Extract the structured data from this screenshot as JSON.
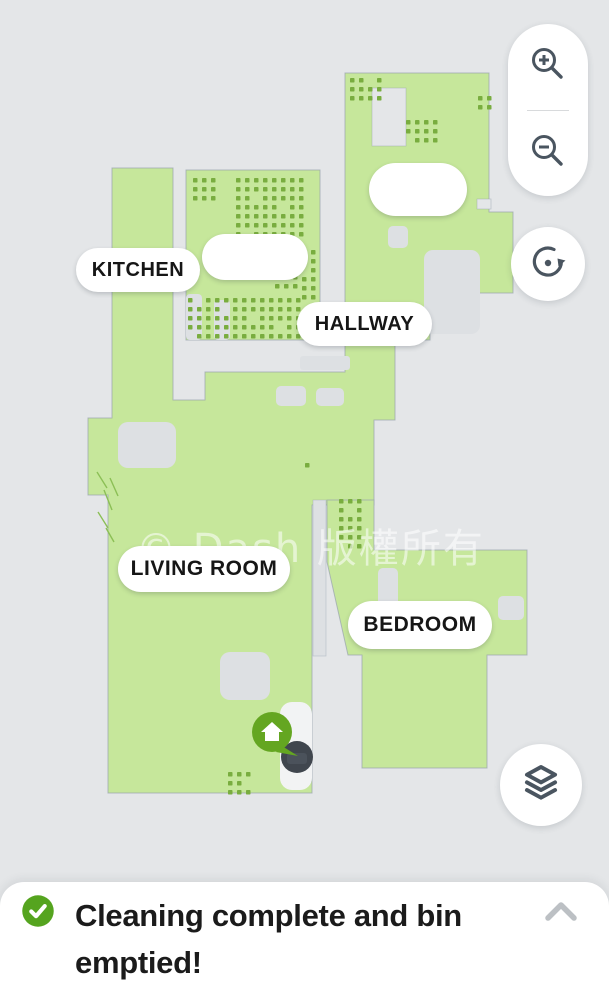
{
  "colors": {
    "background": "#e4e6e8",
    "map_green": "#c6e79b",
    "carpet_dot": "#79ad3f",
    "map_outline": "#97a3ad",
    "obstacle": "#dde0e3",
    "icon": "#4a5560",
    "robot": "#40464e",
    "dock_green": "#64a621",
    "check_green": "#55a41f"
  },
  "map": {
    "rooms": [
      {
        "id": "kitchen",
        "label": "KITCHEN"
      },
      {
        "id": "hallway",
        "label": "HALLWAY"
      },
      {
        "id": "living-room",
        "label": "LIVING ROOM"
      },
      {
        "id": "bedroom",
        "label": "BEDROOM"
      },
      {
        "id": "unnamed-top-room",
        "label": ""
      },
      {
        "id": "unnamed-kitchen-room",
        "label": ""
      }
    ],
    "markers": [
      {
        "id": "dock",
        "icon": "home-icon"
      },
      {
        "id": "robot",
        "icon": "robot-vacuum"
      }
    ],
    "watermark": "© Dash 版權所有"
  },
  "controls": {
    "zoom_in": {
      "icon": "zoom-in-icon"
    },
    "zoom_out": {
      "icon": "zoom-out-icon"
    },
    "rotate": {
      "icon": "rotate-map-icon"
    },
    "layers": {
      "icon": "map-layers-icon"
    }
  },
  "status": {
    "message": "Cleaning complete and bin emptied!",
    "icon": "check-circle-icon",
    "expand_icon": "chevron-up-icon"
  }
}
